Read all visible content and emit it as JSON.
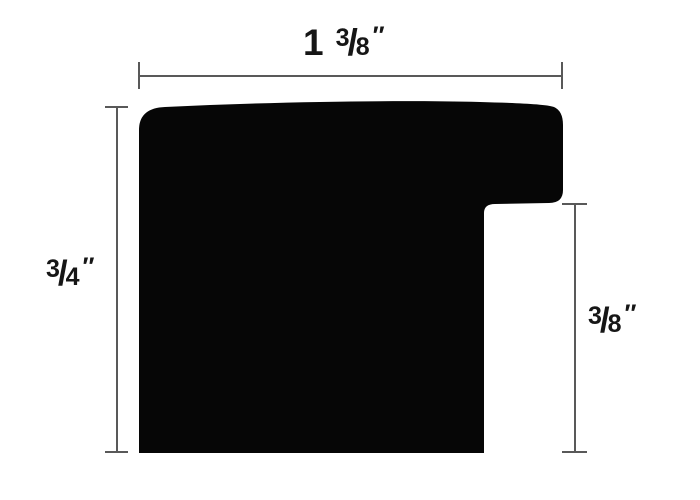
{
  "diagram": {
    "type": "moulding-profile-cross-section",
    "measurements": {
      "overall_width": "1 3/8 inch",
      "overall_height": "3/4 inch",
      "rabbet_height": "3/8 inch"
    }
  },
  "colors": {
    "background": "#ffffff",
    "shape": "#060606",
    "dimension_line": "#595959",
    "text": "#161616"
  },
  "labels": {
    "width": {
      "whole": "1",
      "numerator": "3",
      "slash": "/",
      "denominator": "8",
      "prime": "″"
    },
    "left_height": {
      "numerator": "3",
      "slash": "/",
      "denominator": "4",
      "prime": "″"
    },
    "right_height": {
      "numerator": "3",
      "slash": "/",
      "denominator": "8",
      "prime": "″"
    }
  }
}
